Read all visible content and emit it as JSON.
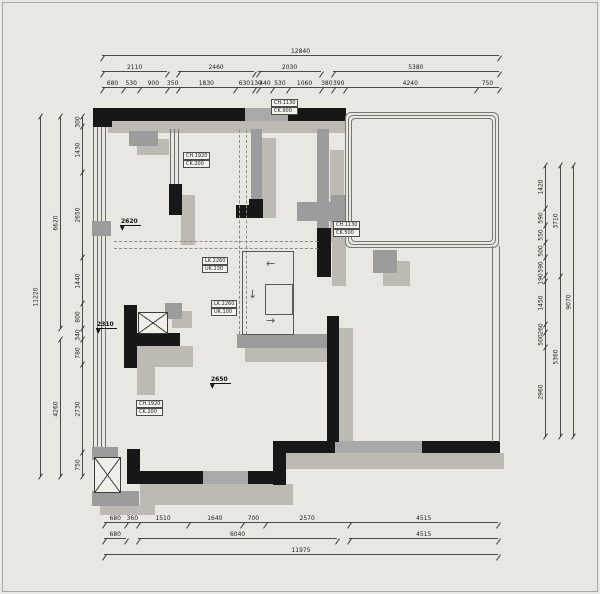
{
  "colors": {
    "background": "#e9e7e2",
    "wall": "#171717",
    "wall_gray": "#9c9c9c",
    "shadow": "#bcbab3",
    "dim_line": "#4a4a4a",
    "text": "#222222"
  },
  "dims": {
    "top": {
      "row1": [
        {
          "v": 12840,
          "t": "12840"
        }
      ],
      "row2": [
        {
          "v": 2110,
          "t": "2110"
        },
        {
          "v": 350,
          "t": ""
        },
        {
          "v": 2460,
          "t": "2460"
        },
        {
          "v": 130,
          "t": ""
        },
        {
          "v": 2030,
          "t": "2030"
        },
        {
          "v": 380,
          "t": ""
        },
        {
          "v": 5380,
          "t": "5380"
        }
      ],
      "row3": [
        {
          "v": 680,
          "t": "680"
        },
        {
          "v": 530,
          "t": "530"
        },
        {
          "v": 900,
          "t": "900"
        },
        {
          "v": 350,
          "t": "350"
        },
        {
          "v": 1830,
          "t": "1830"
        },
        {
          "v": 630,
          "t": "630"
        },
        {
          "v": 130,
          "t": "130"
        },
        {
          "v": 440,
          "t": "440"
        },
        {
          "v": 530,
          "t": "530"
        },
        {
          "v": 1060,
          "t": "1060"
        },
        {
          "v": 380,
          "t": "380"
        },
        {
          "v": 390,
          "t": "390"
        },
        {
          "v": 4240,
          "t": "4240"
        },
        {
          "v": 750,
          "t": "750"
        }
      ]
    },
    "bottom": {
      "row1": [
        {
          "v": 680,
          "t": "680"
        },
        {
          "v": 360,
          "t": "360"
        },
        {
          "v": 1510,
          "t": "1510"
        },
        {
          "v": 1640,
          "t": "1640"
        },
        {
          "v": 700,
          "t": "700"
        },
        {
          "v": 2570,
          "t": "2570"
        },
        {
          "v": 4515,
          "t": "4515"
        }
      ],
      "row2": [
        {
          "v": 680,
          "t": "680"
        },
        {
          "v": 360,
          "t": ""
        },
        {
          "v": 6040,
          "t": "6040"
        },
        {
          "v": 380,
          "t": ""
        },
        {
          "v": 4515,
          "t": "4515"
        }
      ],
      "row3": [
        {
          "v": 11975,
          "t": "11975"
        }
      ]
    },
    "left": {
      "outer": [
        {
          "v": 11220,
          "t": "11220"
        }
      ],
      "mid": [
        {
          "v": 6620,
          "t": "6620"
        },
        {
          "v": 340,
          "t": ""
        },
        {
          "v": 4260,
          "t": "4260"
        }
      ],
      "inner": [
        {
          "v": 300,
          "t": "300"
        },
        {
          "v": 1430,
          "t": "1430"
        },
        {
          "v": 2650,
          "t": "2650"
        },
        {
          "v": 1440,
          "t": "1440"
        },
        {
          "v": 800,
          "t": "800"
        },
        {
          "v": 340,
          "t": "340"
        },
        {
          "v": 780,
          "t": "780"
        },
        {
          "v": 2730,
          "t": "2730"
        },
        {
          "v": 750,
          "t": "750"
        }
      ]
    },
    "right": {
      "outer": [
        {
          "v": 9070,
          "t": "9070"
        }
      ],
      "mid": [
        {
          "v": 3710,
          "t": "3710"
        },
        {
          "v": 5360,
          "t": "5360"
        }
      ],
      "inner": [
        {
          "v": 1420,
          "t": "1420"
        },
        {
          "v": 590,
          "t": "590"
        },
        {
          "v": 550,
          "t": "550"
        },
        {
          "v": 500,
          "t": "500"
        },
        {
          "v": 590,
          "t": "590"
        },
        {
          "v": 190,
          "t": "190"
        },
        {
          "v": 1450,
          "t": "1450"
        },
        {
          "v": 260,
          "t": "260"
        },
        {
          "v": 500,
          "t": "500"
        },
        {
          "v": 2960,
          "t": "2960"
        }
      ]
    }
  },
  "plan": {
    "labels": [
      {
        "l1": "CH.1130",
        "l2": "CK.900"
      },
      {
        "l1": "CH.1920",
        "l2": "CK.200"
      },
      {
        "l1": "LK.2260",
        "l2": "UK.230"
      },
      {
        "l1": "LK.2260",
        "l2": "UK.100"
      },
      {
        "l1": "CH.1130",
        "l2": "CK.500"
      },
      {
        "l1": "CH.1920",
        "l2": "CK.200"
      }
    ],
    "markers": [
      {
        "v": "2620"
      },
      {
        "v": "2310"
      },
      {
        "v": "2650"
      }
    ],
    "icons": {
      "triangle": "▼",
      "arrow_left": "←",
      "arrow_down": "↓",
      "arrow_right": "→"
    }
  }
}
